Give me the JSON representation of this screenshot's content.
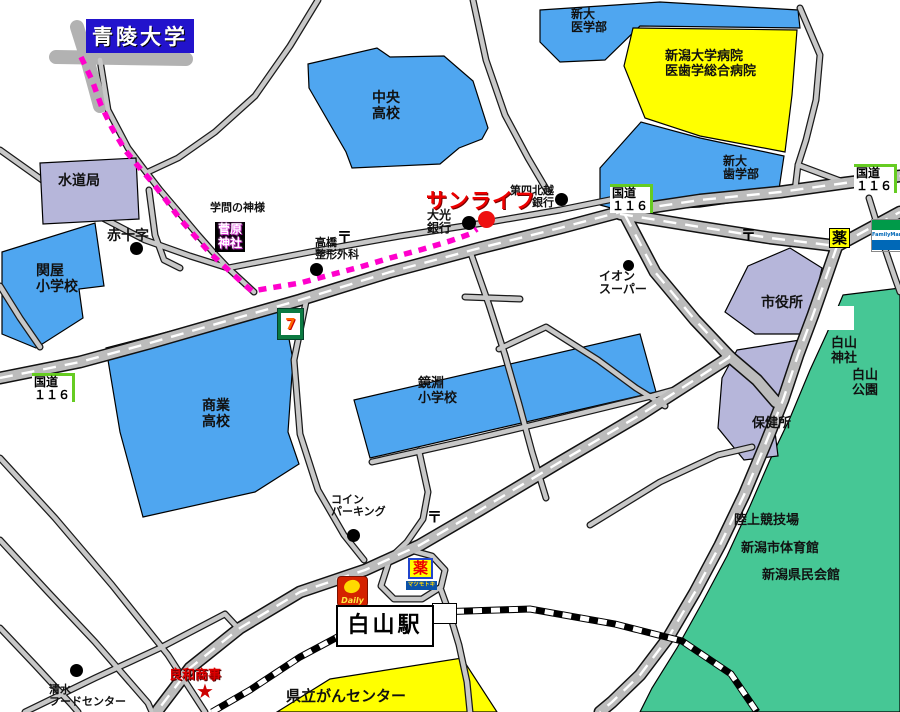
{
  "labels": {
    "seiryo_univ": "青陵大学",
    "suidokyoku": "水道局",
    "sekiya_elementary": "関屋\n小学校",
    "red_cross": "赤十字",
    "gakumon": "学問の神様",
    "sugawara_shrine": "菅原\n神社",
    "chuo_highschool": "中央\n高校",
    "shindai_med": "新大\n医学部",
    "niigata_univ_hospital": "新潟大学病院\n医歯学総合病院",
    "shindai_dental": "新大\n歯学部",
    "kokudo116": "国道\n１１６",
    "yaku": "薬",
    "sunlife": "サンライフ",
    "daiko_bank": "大光\n銀行",
    "daishi_hokuetsu_bank": "第四北越\n銀行",
    "takahashi_seikei": "高橋\n整形外科",
    "aeon_super": "イオン\nスーパー",
    "city_hall": "市役所",
    "hakusan_shrine": "白山\n神社",
    "hakusan_park": "白山\n公園",
    "hokenjo": "保健所",
    "shogyo_highschool": "商業\n高校",
    "kagamibuchi_elementary": "鏡淵\n小学校",
    "coin_parking": "コイン\nパーキング",
    "rikujo_kyogijo": "陸上競技場",
    "shi_taiikukan": "新潟市体育館",
    "kenmin_kaikan": "新潟県民会館",
    "hakusan_station": "白山駅",
    "ryowa_shoji": "良和商事",
    "shimizu_food": "清水\nフードセンター",
    "kenritsu_gan_center": "県立がんセンター",
    "seven_eleven": "7",
    "daily": "Daily",
    "familymart": "FamilyMart",
    "matsumoto_kiyoshi": "マツモトキヨシ",
    "postal_mark": "〒",
    "star_mark": "★"
  },
  "colors": {
    "building_blue": "#4fa6f0",
    "building_yellow": "#ffff00",
    "building_purple": "#b6b6da",
    "park_green": "#46c795",
    "route_magenta": "#ff00cc",
    "sunlife_red": "#ee0000",
    "seiryo_badge_blue": "#2213cc",
    "kokudo_green": "#66cc22",
    "road_gray": "#c8c8c8"
  }
}
